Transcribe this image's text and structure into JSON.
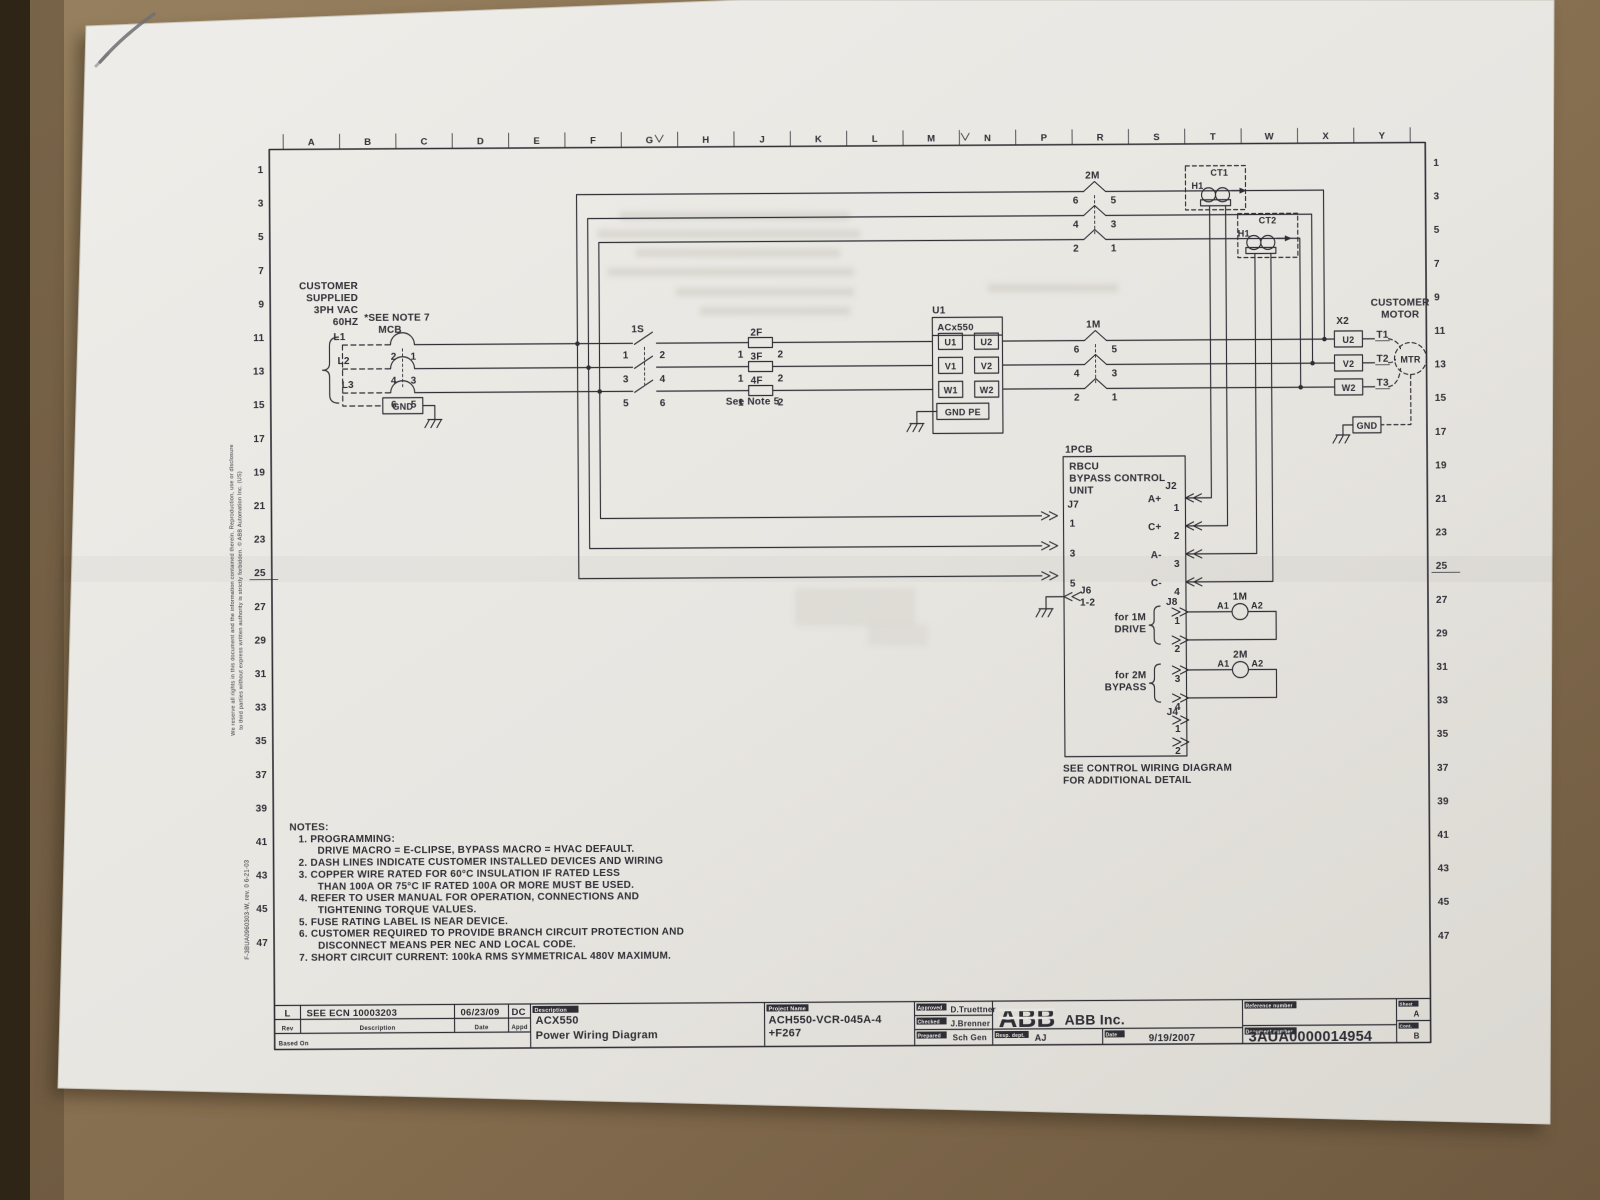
{
  "colors": {
    "desk": "#8b7254",
    "desk2": "#6e5940",
    "desk_dark": "#2f2517",
    "paper": "#e9e7e2",
    "paper2": "#d9d6d0",
    "ink": "#2e2e35",
    "smudge": "#c8c4bb",
    "pencil": "#6f6f72",
    "shadow": "#3a2d1d"
  },
  "grid": {
    "cols": [
      "A",
      "B",
      "C",
      "D",
      "E",
      "F",
      "G",
      "H",
      "J",
      "K",
      "L",
      "M",
      "N",
      "P",
      "R",
      "S",
      "T",
      "W",
      "X",
      "Y"
    ],
    "rows": [
      "1",
      "3",
      "5",
      "7",
      "9",
      "11",
      "13",
      "15",
      "17",
      "19",
      "21",
      "23",
      "25",
      "27",
      "29",
      "31",
      "33",
      "35",
      "37",
      "39",
      "41",
      "43",
      "45",
      "47"
    ]
  },
  "notes": {
    "lines": [
      {
        "t": "NOTES:",
        "i": 0
      },
      {
        "t": "1.  PROGRAMMING:",
        "i": 1
      },
      {
        "t": "DRIVE MACRO = E-CLIPSE, BYPASS MACRO = HVAC DEFAULT.",
        "i": 2
      },
      {
        "t": "2.  DASH LINES INDICATE CUSTOMER INSTALLED DEVICES AND WIRING",
        "i": 1
      },
      {
        "t": "3.  COPPER WIRE RATED FOR 60°C INSULATION IF RATED LESS",
        "i": 1
      },
      {
        "t": "THAN 100A OR 75°C IF RATED 100A OR MORE MUST BE USED.",
        "i": 2
      },
      {
        "t": "4.  REFER TO USER MANUAL FOR OPERATION, CONNECTIONS AND",
        "i": 1
      },
      {
        "t": "TIGHTENING TORQUE VALUES.",
        "i": 2
      },
      {
        "t": "5.  FUSE RATING LABEL IS NEAR DEVICE.",
        "i": 1
      },
      {
        "t": "6.  CUSTOMER REQUIRED TO PROVIDE BRANCH CIRCUIT PROTECTION AND",
        "i": 1
      },
      {
        "t": "DISCONNECT MEANS PER NEC AND LOCAL CODE.",
        "i": 2
      },
      {
        "t": "7.  SHORT CIRCUIT CURRENT:  100kA RMS SYMMETRICAL 480V MAXIMUM.",
        "i": 1
      }
    ]
  },
  "labels": [
    {
      "n": "supply-line1",
      "t": "CUSTOMER",
      "x": 360,
      "y": 286,
      "a": "end"
    },
    {
      "n": "supply-line2",
      "t": "SUPPLIED",
      "x": 360,
      "y": 298,
      "a": "end"
    },
    {
      "n": "supply-line3",
      "t": "3PH VAC",
      "x": 360,
      "y": 310,
      "a": "end"
    },
    {
      "n": "supply-line4",
      "t": "60HZ",
      "x": 360,
      "y": 322,
      "a": "end"
    },
    {
      "n": "see-note-7",
      "t": "*SEE NOTE 7",
      "x": 366,
      "y": 318
    },
    {
      "n": "mcb-label",
      "t": "MCB",
      "x": 380,
      "y": 330
    },
    {
      "n": "phase-l1",
      "t": "L1",
      "x": 335,
      "y": 337
    },
    {
      "n": "phase-l2",
      "t": "L2",
      "x": 339,
      "y": 361
    },
    {
      "n": "phase-l3",
      "t": "L3",
      "x": 343,
      "y": 385
    },
    {
      "n": "mcb-pin",
      "t": "2",
      "x": 398,
      "y": 357,
      "a": "end"
    },
    {
      "n": "mcb-pin",
      "t": "1",
      "x": 412,
      "y": 357
    },
    {
      "n": "mcb-pin",
      "t": "4",
      "x": 398,
      "y": 381,
      "a": "end"
    },
    {
      "n": "mcb-pin",
      "t": "3",
      "x": 412,
      "y": 381
    },
    {
      "n": "mcb-pin",
      "t": "6",
      "x": 398,
      "y": 405,
      "a": "end"
    },
    {
      "n": "mcb-pin",
      "t": "5",
      "x": 412,
      "y": 405
    },
    {
      "n": "feed-gnd",
      "t": "GND",
      "x": 404,
      "y": 407,
      "a": "middle",
      "s": 9
    },
    {
      "n": "switch-1s-label",
      "t": "1S",
      "x": 633,
      "y": 331
    },
    {
      "n": "1s-pin",
      "t": "1",
      "x": 630,
      "y": 357,
      "a": "end"
    },
    {
      "n": "1s-pin",
      "t": "2",
      "x": 661,
      "y": 357
    },
    {
      "n": "1s-pin",
      "t": "3",
      "x": 630,
      "y": 381,
      "a": "end"
    },
    {
      "n": "1s-pin",
      "t": "4",
      "x": 661,
      "y": 381
    },
    {
      "n": "1s-pin",
      "t": "5",
      "x": 630,
      "y": 405,
      "a": "end"
    },
    {
      "n": "1s-pin",
      "t": "6",
      "x": 661,
      "y": 405
    },
    {
      "n": "fuse-2f-label",
      "t": "2F",
      "x": 752,
      "y": 335
    },
    {
      "n": "fuse-3f-label",
      "t": "3F",
      "x": 752,
      "y": 359
    },
    {
      "n": "fuse-4f-label",
      "t": "4F",
      "x": 752,
      "y": 383
    },
    {
      "n": "fuse-pin",
      "t": "1",
      "x": 745,
      "y": 357,
      "a": "end"
    },
    {
      "n": "fuse-pin",
      "t": "2",
      "x": 779,
      "y": 357
    },
    {
      "n": "fuse-pin",
      "t": "1",
      "x": 745,
      "y": 381,
      "a": "end"
    },
    {
      "n": "fuse-pin",
      "t": "2",
      "x": 779,
      "y": 381
    },
    {
      "n": "fuse-pin",
      "t": "1",
      "x": 745,
      "y": 405,
      "a": "end"
    },
    {
      "n": "fuse-pin",
      "t": "2",
      "x": 779,
      "y": 405
    },
    {
      "n": "see-note-5",
      "t": "See Note 5",
      "x": 727,
      "y": 404
    },
    {
      "n": "drive-designator",
      "t": "U1",
      "x": 934,
      "y": 314
    },
    {
      "n": "drive-type",
      "t": "ACx550",
      "x": 939,
      "y": 331,
      "s": 9.5
    },
    {
      "n": "drive-term",
      "t": "U1",
      "x": 952,
      "y": 346,
      "a": "middle",
      "s": 9
    },
    {
      "n": "drive-term",
      "t": "V1",
      "x": 952,
      "y": 370,
      "a": "middle",
      "s": 9
    },
    {
      "n": "drive-term",
      "t": "W1",
      "x": 952,
      "y": 394,
      "a": "middle",
      "s": 9
    },
    {
      "n": "drive-term",
      "t": "U2",
      "x": 988,
      "y": 346,
      "a": "middle",
      "s": 9
    },
    {
      "n": "drive-term",
      "t": "V2",
      "x": 988,
      "y": 370,
      "a": "middle",
      "s": 9
    },
    {
      "n": "drive-term",
      "t": "W2",
      "x": 988,
      "y": 394,
      "a": "middle",
      "s": 9
    },
    {
      "n": "drive-gnd",
      "t": "GND PE",
      "x": 964,
      "y": 416,
      "a": "middle",
      "s": 9
    },
    {
      "n": "contactor-1m-label",
      "t": "1M",
      "x": 1095,
      "y": 329,
      "a": "middle"
    },
    {
      "n": "1m-pin",
      "t": "6",
      "x": 1081,
      "y": 354,
      "a": "end"
    },
    {
      "n": "1m-pin",
      "t": "5",
      "x": 1113,
      "y": 354
    },
    {
      "n": "1m-pin",
      "t": "4",
      "x": 1081,
      "y": 378,
      "a": "end"
    },
    {
      "n": "1m-pin",
      "t": "3",
      "x": 1113,
      "y": 378
    },
    {
      "n": "1m-pin",
      "t": "2",
      "x": 1081,
      "y": 402,
      "a": "end"
    },
    {
      "n": "1m-pin",
      "t": "1",
      "x": 1113,
      "y": 402
    },
    {
      "n": "contactor-2m-label",
      "t": "2M",
      "x": 1095,
      "y": 180,
      "a": "middle"
    },
    {
      "n": "2m-pin",
      "t": "6",
      "x": 1081,
      "y": 205,
      "a": "end"
    },
    {
      "n": "2m-pin",
      "t": "5",
      "x": 1113,
      "y": 205
    },
    {
      "n": "2m-pin",
      "t": "4",
      "x": 1081,
      "y": 229,
      "a": "end"
    },
    {
      "n": "2m-pin",
      "t": "3",
      "x": 1113,
      "y": 229
    },
    {
      "n": "2m-pin",
      "t": "2",
      "x": 1081,
      "y": 253,
      "a": "end"
    },
    {
      "n": "2m-pin",
      "t": "1",
      "x": 1113,
      "y": 253
    },
    {
      "n": "ct1-label",
      "t": "CT1",
      "x": 1213,
      "y": 178,
      "s": 9
    },
    {
      "n": "ct1-h1",
      "t": "H1",
      "x": 1206,
      "y": 191,
      "a": "end",
      "s": 9
    },
    {
      "n": "ct2-label",
      "t": "CT2",
      "x": 1261,
      "y": 226,
      "s": 9
    },
    {
      "n": "ct2-h1",
      "t": "H1",
      "x": 1252,
      "y": 239,
      "a": "end",
      "s": 9
    },
    {
      "n": "x2-label",
      "t": "X2",
      "x": 1338,
      "y": 327
    },
    {
      "n": "x2-term",
      "t": "U2",
      "x": 1350,
      "y": 346,
      "a": "middle",
      "s": 9
    },
    {
      "n": "x2-term",
      "t": "V2",
      "x": 1350,
      "y": 370,
      "a": "middle",
      "s": 9
    },
    {
      "n": "x2-term",
      "t": "W2",
      "x": 1350,
      "y": 394,
      "a": "middle",
      "s": 9
    },
    {
      "n": "motor-lead",
      "t": "T1",
      "x": 1378,
      "y": 341
    },
    {
      "n": "motor-lead",
      "t": "T2",
      "x": 1378,
      "y": 365
    },
    {
      "n": "motor-lead",
      "t": "T3",
      "x": 1378,
      "y": 389
    },
    {
      "n": "customer-motor-1",
      "t": "CUSTOMER",
      "x": 1402,
      "y": 309,
      "a": "middle"
    },
    {
      "n": "customer-motor-2",
      "t": "MOTOR",
      "x": 1402,
      "y": 321,
      "a": "middle"
    },
    {
      "n": "motor-circle-label",
      "t": "MTR",
      "x": 1412,
      "y": 366,
      "a": "middle",
      "s": 9
    },
    {
      "n": "motor-gnd",
      "t": "GND",
      "x": 1368,
      "y": 432,
      "a": "middle",
      "s": 9
    },
    {
      "n": "pcb-designator",
      "t": "1PCB",
      "x": 1066,
      "y": 454
    },
    {
      "n": "rbcu-1",
      "t": "RBCU",
      "x": 1070,
      "y": 471
    },
    {
      "n": "rbcu-2",
      "t": "BYPASS CONTROL",
      "x": 1070,
      "y": 483
    },
    {
      "n": "rbcu-3",
      "t": "UNIT",
      "x": 1070,
      "y": 495
    },
    {
      "n": "j7-label",
      "t": "J7",
      "x": 1068,
      "y": 509
    },
    {
      "n": "j7-pin",
      "t": "1",
      "x": 1070,
      "y": 528
    },
    {
      "n": "j7-pin",
      "t": "3",
      "x": 1070,
      "y": 558
    },
    {
      "n": "j7-pin",
      "t": "5",
      "x": 1070,
      "y": 588
    },
    {
      "n": "j6-label",
      "t": "J6",
      "x": 1080,
      "y": 595
    },
    {
      "n": "j6-pins",
      "t": "1-2",
      "x": 1080,
      "y": 607
    },
    {
      "n": "j2-label",
      "t": "J2",
      "x": 1166,
      "y": 491
    },
    {
      "n": "j2-sig",
      "t": "A+",
      "x": 1162,
      "y": 504,
      "a": "end"
    },
    {
      "n": "j2-pin",
      "t": "1",
      "x": 1180,
      "y": 513,
      "a": "end"
    },
    {
      "n": "j2-sig",
      "t": "C+",
      "x": 1162,
      "y": 532,
      "a": "end"
    },
    {
      "n": "j2-pin",
      "t": "2",
      "x": 1180,
      "y": 541,
      "a": "end"
    },
    {
      "n": "j2-sig",
      "t": "A-",
      "x": 1162,
      "y": 560,
      "a": "end"
    },
    {
      "n": "j2-pin",
      "t": "3",
      "x": 1180,
      "y": 569,
      "a": "end"
    },
    {
      "n": "j2-sig",
      "t": "C-",
      "x": 1162,
      "y": 588,
      "a": "end"
    },
    {
      "n": "j2-pin",
      "t": "4",
      "x": 1180,
      "y": 597,
      "a": "end"
    },
    {
      "n": "j8-label",
      "t": "J8",
      "x": 1166,
      "y": 607
    },
    {
      "n": "j8-for-1m",
      "t": "for 1M",
      "x": 1146,
      "y": 622,
      "a": "end"
    },
    {
      "n": "j8-drive",
      "t": "DRIVE",
      "x": 1146,
      "y": 634,
      "a": "end"
    },
    {
      "n": "j8-for-2m",
      "t": "for 2M",
      "x": 1146,
      "y": 680,
      "a": "end"
    },
    {
      "n": "j8-bypass",
      "t": "BYPASS",
      "x": 1146,
      "y": 692,
      "a": "end"
    },
    {
      "n": "j8-pin",
      "t": "1",
      "x": 1180,
      "y": 626,
      "a": "end"
    },
    {
      "n": "j8-pin",
      "t": "2",
      "x": 1180,
      "y": 654,
      "a": "end"
    },
    {
      "n": "j8-pin",
      "t": "3",
      "x": 1180,
      "y": 684,
      "a": "end"
    },
    {
      "n": "j8-pin",
      "t": "4",
      "x": 1180,
      "y": 712,
      "a": "end"
    },
    {
      "n": "coil-1m-label",
      "t": "1M",
      "x": 1240,
      "y": 602,
      "a": "middle"
    },
    {
      "n": "coil-1m-a1",
      "t": "A1",
      "x": 1229,
      "y": 611,
      "a": "end",
      "s": 9
    },
    {
      "n": "coil-1m-a2",
      "t": "A2",
      "x": 1251,
      "y": 611,
      "s": 9
    },
    {
      "n": "coil-2m-label",
      "t": "2M",
      "x": 1240,
      "y": 660,
      "a": "middle"
    },
    {
      "n": "coil-2m-a1",
      "t": "A1",
      "x": 1229,
      "y": 669,
      "a": "end",
      "s": 9
    },
    {
      "n": "coil-2m-a2",
      "t": "A2",
      "x": 1251,
      "y": 669,
      "s": 9
    },
    {
      "n": "j4-label",
      "t": "J4",
      "x": 1166,
      "y": 717
    },
    {
      "n": "j4-pin",
      "t": "1",
      "x": 1180,
      "y": 734,
      "a": "end"
    },
    {
      "n": "j4-pin",
      "t": "2",
      "x": 1180,
      "y": 756,
      "a": "end"
    },
    {
      "n": "see-control-1",
      "t": "SEE CONTROL WIRING DIAGRAM",
      "x": 1062,
      "y": 773
    },
    {
      "n": "see-control-2",
      "t": "FOR ADDITIONAL DETAIL",
      "x": 1062,
      "y": 785
    },
    {
      "n": "margin-copyright-1",
      "t": "We reserve all rights in this document and the information contained therein. Reproduction, use or disclosure",
      "x": 234,
      "y": 732,
      "s": 5.5,
      "r": -90,
      "w": 400
    },
    {
      "n": "margin-copyright-2",
      "t": "to third parties without express written authority is strictly forbidden.  © ABB Automation Inc. (US)",
      "x": 242,
      "y": 726,
      "s": 5.5,
      "r": -90,
      "w": 400
    },
    {
      "n": "margin-form-number",
      "t": "F-3BUA0960303-W,  rev. 0  6-21-03",
      "x": 247,
      "y": 956,
      "s": 6,
      "r": -90,
      "w": 400
    }
  ],
  "title_block": {
    "rev_value": "L",
    "rev_desc": "SEE ECN 10003203",
    "rev_date": "06/23/09",
    "rev_appd": "DC",
    "hdr_rev": "Rev",
    "hdr_desc": "Description",
    "hdr_date": "Date",
    "hdr_appd": "Appd",
    "based_on": "Based On",
    "hdr_description": "Description",
    "description1": "ACX550",
    "description2": "Power Wiring Diagram",
    "hdr_project": "Project Name",
    "project1": "ACH550-VCR-045A-4",
    "project2": "+F267",
    "hdr_approved": "Approved",
    "approved_by": "D.Truettner",
    "hdr_checked": "Checked",
    "checked_by": "J.Brenner",
    "hdr_prepared": "Prepared",
    "prepared_by": "Sch Gen",
    "abb_logo": "ABB",
    "company": "ABB Inc.",
    "hdr_resp": "Resp. dept.",
    "resp_dept": "AJ",
    "hdr_date2": "Date",
    "date": "9/19/2007",
    "hdr_reference": "Reference number",
    "hdr_document": "Document number",
    "doc_number": "3AUA0000014954",
    "hdr_sheet": "Sheet",
    "sheet": "A",
    "hdr_cont": "Cont.",
    "cont": "B"
  }
}
